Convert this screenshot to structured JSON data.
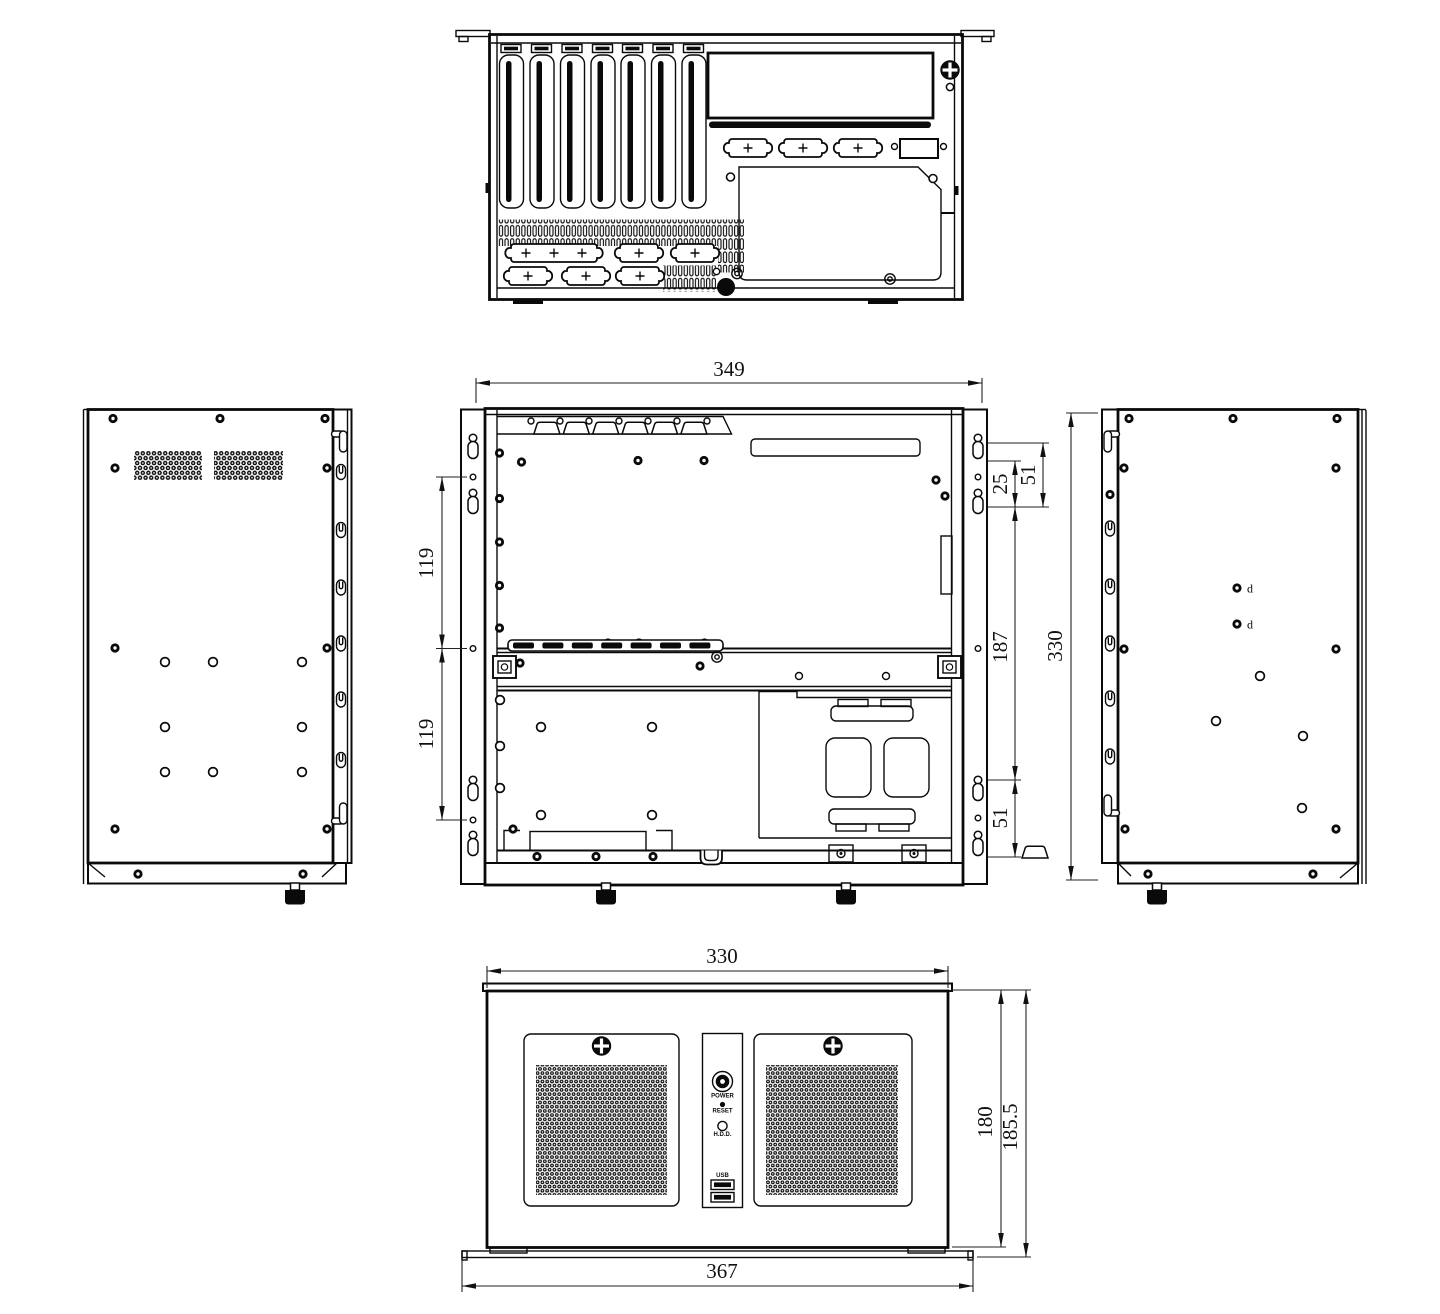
{
  "dims": {
    "rack_width": "349",
    "left_pitch_upper": "119",
    "left_pitch_lower": "119",
    "keyhole_offset": "25",
    "keyhole_pitch_top": "51",
    "keyhole_span": "187",
    "keyhole_pitch_bottom": "51",
    "side_height": "330",
    "front_width": "330",
    "front_height": "180",
    "front_height_overall": "185.5",
    "front_width_overall": "367"
  },
  "front_panel": {
    "power": "POWER",
    "reset": "RESET",
    "hdd": "H.D.D.",
    "usb": "USB"
  },
  "side_panel": {
    "hole_d_upper": "d",
    "hole_d_lower": "d"
  }
}
